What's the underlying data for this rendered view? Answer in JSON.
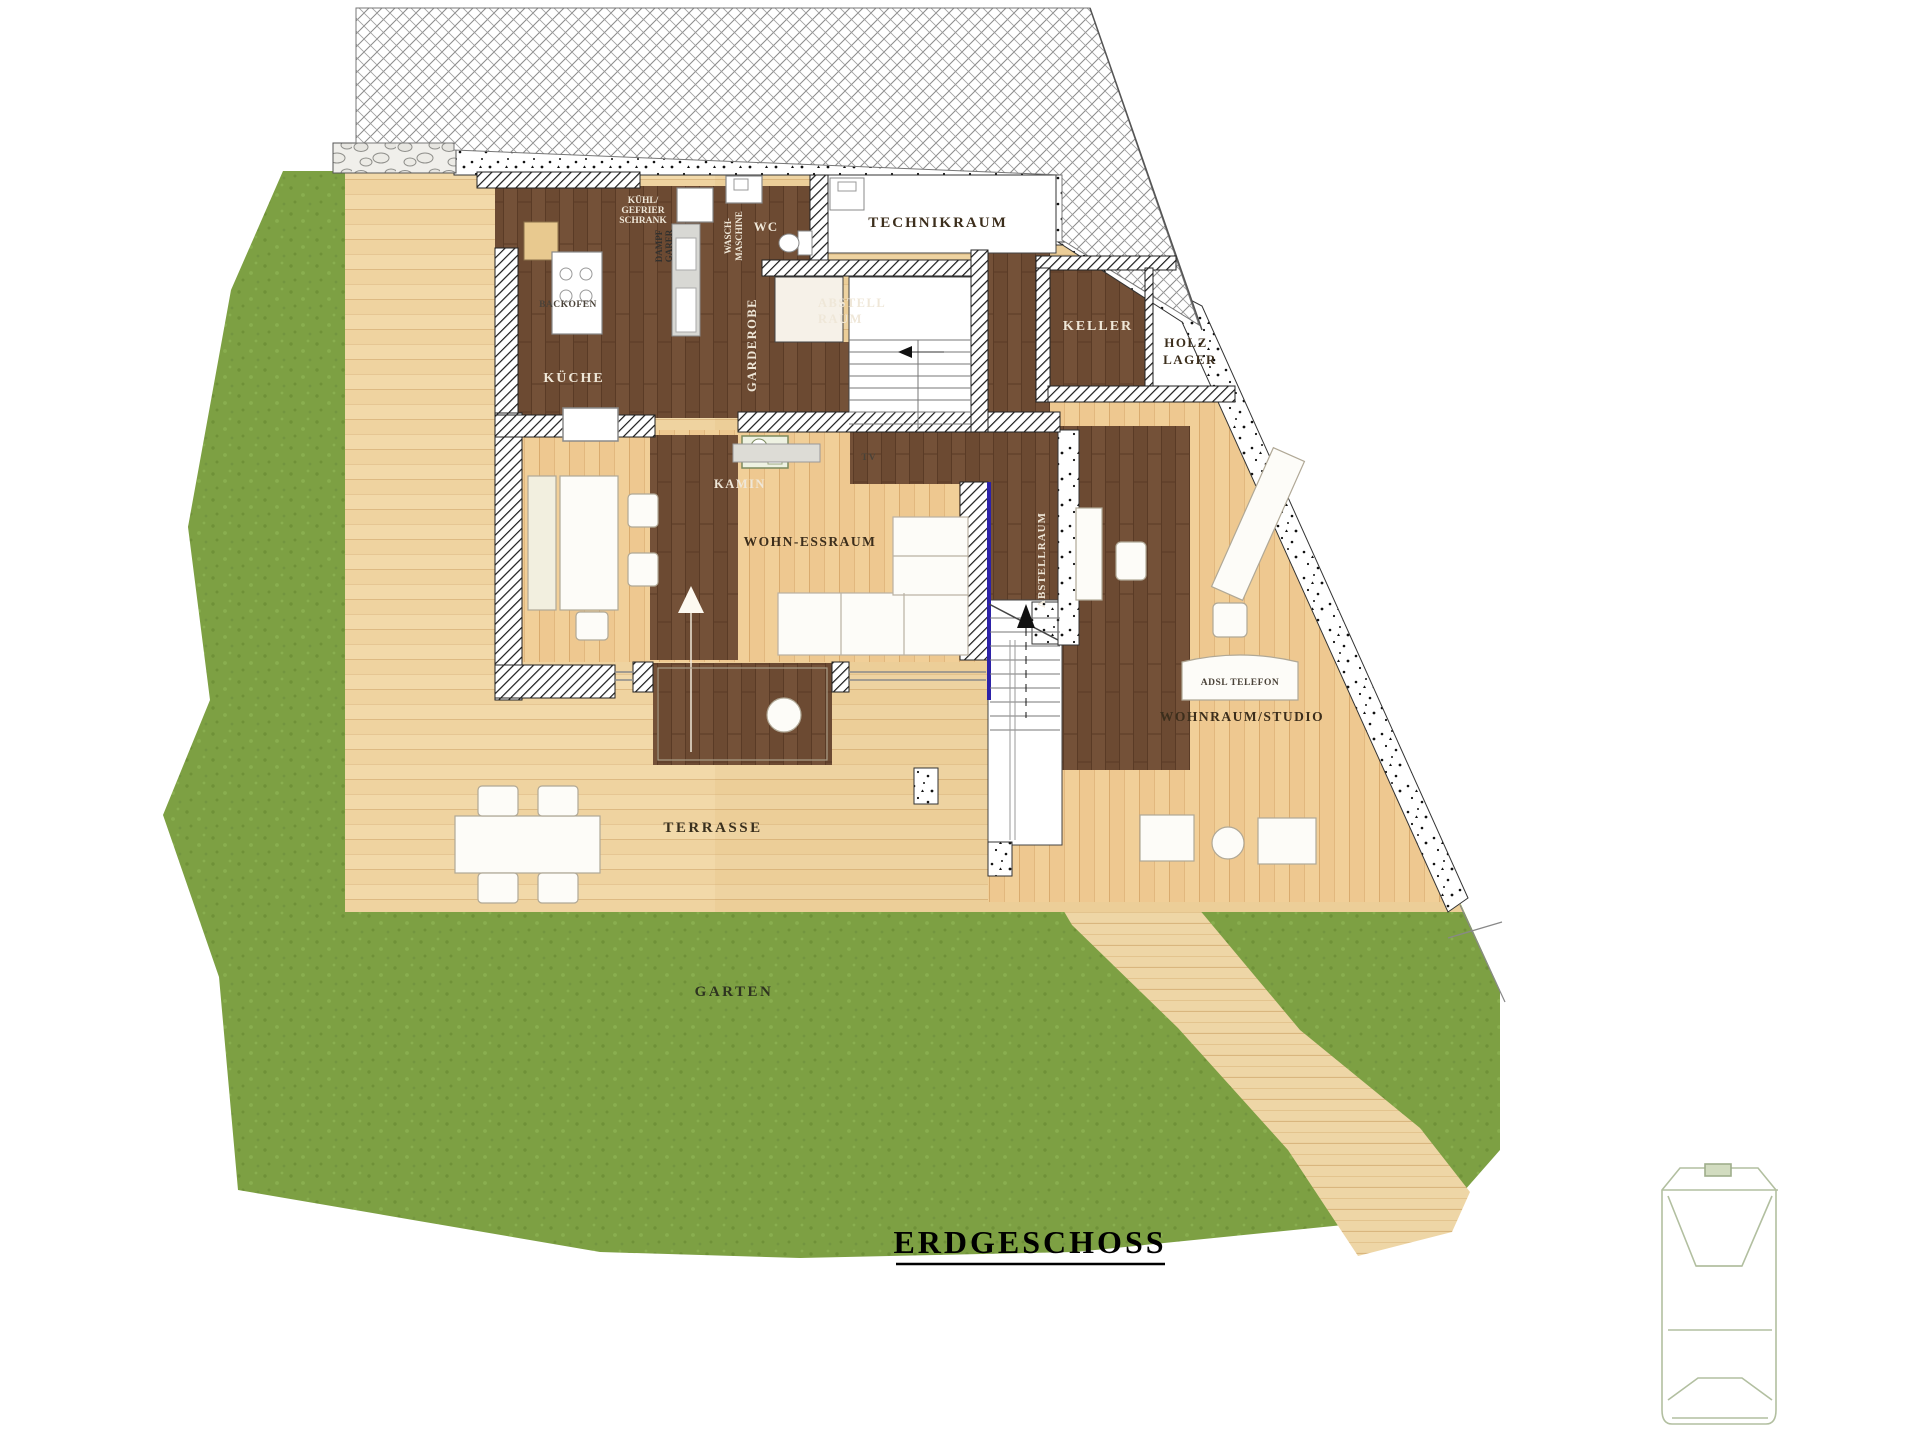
{
  "title": {
    "text": "ERDGESCHOSS"
  },
  "site_labels": {
    "terrasse": "TERRASSE",
    "garten": "GARTEN"
  },
  "rooms": {
    "technikraum": "TECHNIKRAUM",
    "keller": "KELLER",
    "holz_line1": "HOLZ",
    "holz_line2": "LAGER",
    "wc": "WC",
    "abstell_line1": "ABSTELL",
    "abstell_line2": "RAUM",
    "kueche": "KÜCHE",
    "garderobe": "GARDEROBE",
    "kamin": "KAMIN",
    "tv": "TV",
    "wohn_essraum": "WOHN-ESSRAUM",
    "abstellraum_vertical": "ABSTELLRAUM",
    "wohnraum_studio": "WOHNRAUM/STUDIO"
  },
  "appliances": {
    "kuehl_line1": "KÜHL/",
    "kuehl_line2": "GEFRIER",
    "kuehl_line3": "SCHRANK",
    "dampf_line1": "DAMPF",
    "dampf_line2": "GARER",
    "wasch_line1": "WASCH-",
    "wasch_line2": "MASCHINE",
    "backofen": "BACKOFEN",
    "adsl_telefon": "ADSL TELEFON"
  },
  "colors": {
    "walnut_floor": "#6c4a32",
    "interior_wood": "#f0cf97",
    "terrace_wood": "#f2d9a9",
    "grass": "#7da043",
    "glass_partition_line": "#2d22a8",
    "wall_hatch_line": "#1a1a1a",
    "label_dark": "#3c2e1c",
    "label_light": "#efe7d8",
    "title_color": "#000000",
    "car_outline": "#b2bfa0"
  }
}
